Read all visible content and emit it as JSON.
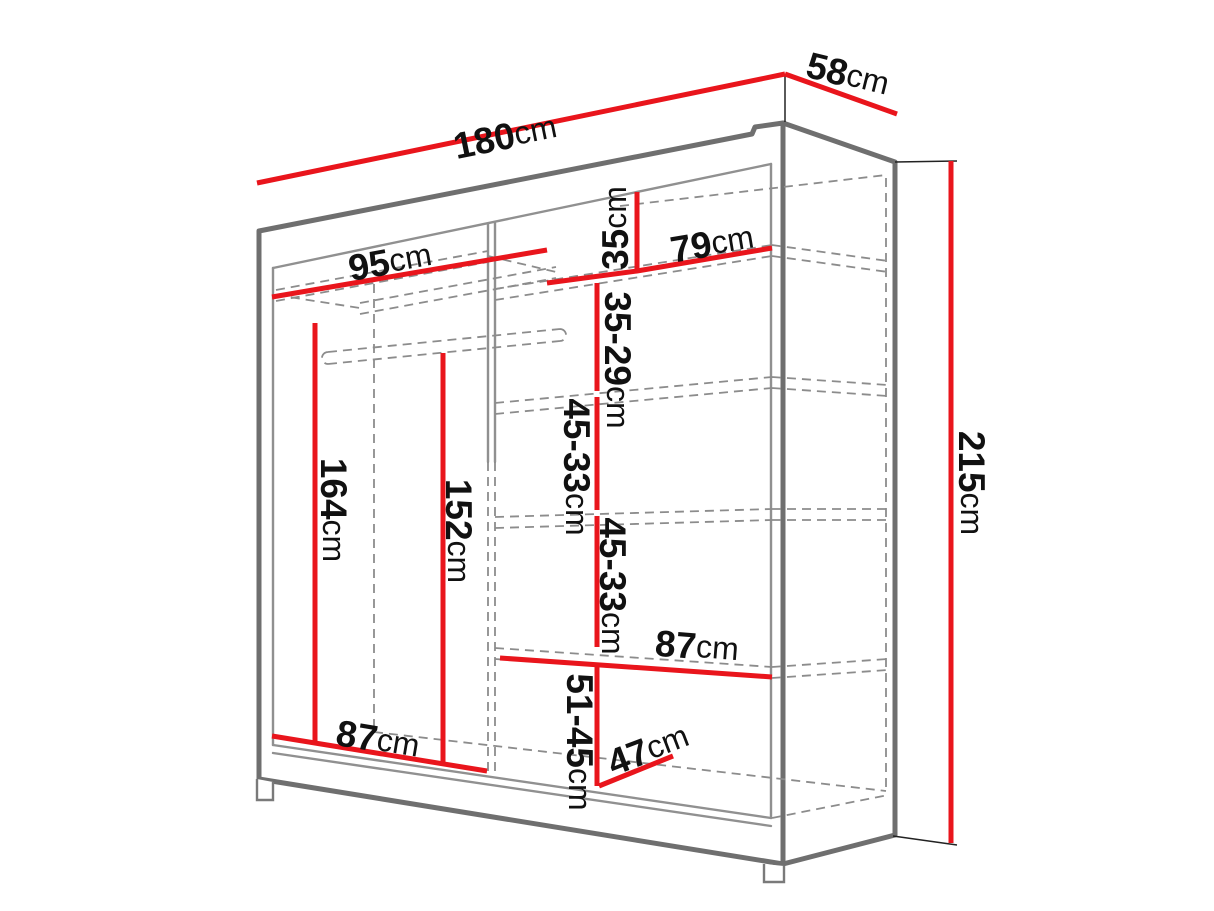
{
  "diagram": {
    "name": "sliding-wardrobe-dimension-diagram",
    "colors": {
      "dimension": "#e9151c",
      "structure": "#6f6f6f",
      "hidden": "#8c8c8c",
      "label": "#111111",
      "background": "#ffffff"
    },
    "dimensions": {
      "total_width": {
        "value": "180",
        "unit": "cm"
      },
      "total_depth": {
        "value": "58",
        "unit": "cm"
      },
      "total_height": {
        "value": "215",
        "unit": "cm"
      },
      "left_shelf_width": {
        "value": "95",
        "unit": "cm"
      },
      "top_gap": {
        "value": "35",
        "unit": "cm"
      },
      "right_shelf_width": {
        "value": "79",
        "unit": "cm"
      },
      "shelf_gap_1": {
        "value": "35-29",
        "unit": "cm"
      },
      "shelf_gap_2": {
        "value": "45-33",
        "unit": "cm"
      },
      "shelf_gap_3": {
        "value": "45-33",
        "unit": "cm"
      },
      "middle_shelf_width": {
        "value": "87",
        "unit": "cm"
      },
      "bottom_gap": {
        "value": "51-45",
        "unit": "cm"
      },
      "bottom_depth": {
        "value": "47",
        "unit": "cm"
      },
      "left_section_width": {
        "value": "87",
        "unit": "cm"
      },
      "rail_height_back": {
        "value": "164",
        "unit": "cm"
      },
      "rail_height_front": {
        "value": "152",
        "unit": "cm"
      }
    }
  }
}
